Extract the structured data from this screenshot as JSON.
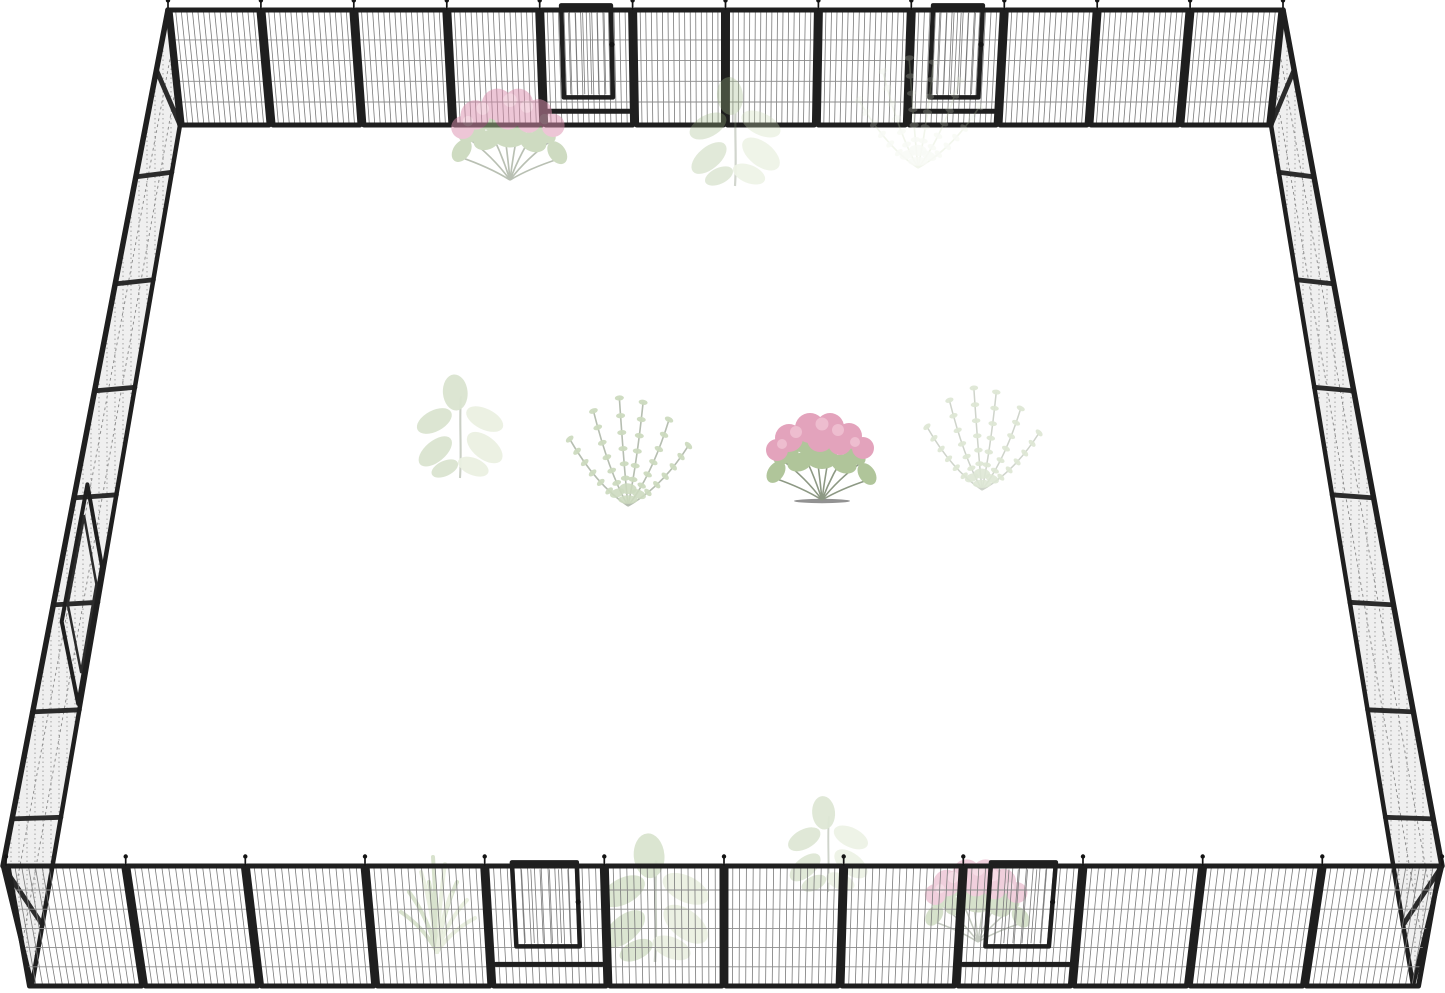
{
  "scene": {
    "description": "Product photo of a black metal heavy-duty dog playpen arranged as a large square outdoor enclosure viewed in perspective, with wire-mesh panels, five access gates (two on the far side, two on the near side, one on the left side), and faint semi-transparent garden plants (pink hydrangea bushes, broad-leaf plants, feathery green plants) inside the pen on a pure white background",
    "canvas": {
      "width": 1445,
      "height": 993,
      "background": "#ffffff"
    },
    "colors": {
      "frame": "#1f1f1f",
      "frame_soft": "#2b2b2b",
      "wire": "#7a7a7a",
      "rail_wire": "#8c8c8c",
      "side_fill": "#ededed",
      "side_wire": "#8f8f8f",
      "pin": "#141414",
      "flower_pink": "#dd8fae",
      "flower_pink_light": "#ecb3c8",
      "leaf_green": "#9fb985",
      "leaf_light": "#cbdab4",
      "leaf_pale": "#e3ebd8",
      "stem": "#75836a",
      "shadow": "#5a5a5a"
    },
    "fence": {
      "top_row": {
        "x1": 168,
        "x2": 1283,
        "y_top": 10,
        "y_bottom": 125,
        "panels": 12,
        "gates": [
          4,
          8
        ],
        "vanish_x": 724,
        "skew": 0.022,
        "rails": [
          0.26,
          0.44,
          0.62,
          0.8
        ],
        "wires": 16,
        "door": {
          "u1": 0.22,
          "u2": 0.78,
          "f_top": -0.04,
          "f_bottom": 0.76,
          "f_thresh": 0.88
        }
      },
      "bottom_row": {
        "x1": 6,
        "x2": 1442,
        "y_top": 866,
        "y_bottom": 986,
        "panels": 12,
        "gates": [
          4,
          8
        ],
        "vanish_x": 724,
        "skew": 0.03,
        "rails": [
          0.2,
          0.36,
          0.52,
          0.68,
          0.84
        ],
        "wires": 17,
        "door": {
          "u1": 0.22,
          "u2": 0.78,
          "f_top": -0.03,
          "f_bottom": 0.67,
          "f_thresh": 0.82
        }
      },
      "left_side": {
        "top_rail": [
          [
            168,
            10
          ],
          [
            3,
            866
          ]
        ],
        "base_rail": [
          [
            180,
            125
          ],
          [
            32,
            985
          ]
        ],
        "panels": 8,
        "post_shift": 0.14,
        "gate": {
          "t1": 0.52,
          "t2": 0.68,
          "u1": 0.25,
          "u2": 0.95
        }
      },
      "right_side": {
        "top_rail": [
          [
            1283,
            10
          ],
          [
            1442,
            866
          ]
        ],
        "base_rail": [
          [
            1271,
            125
          ],
          [
            1413,
            985
          ]
        ],
        "panels": 8,
        "post_shift": -0.14,
        "gate": null
      }
    },
    "plants": [
      {
        "type": "hydrangea",
        "x": 510,
        "y": 180,
        "scale": 1.05,
        "opacity": 0.5,
        "layer": "front-top"
      },
      {
        "type": "broadleaf",
        "x": 735,
        "y": 186,
        "scale": 1.0,
        "opacity": 0.33,
        "layer": "front-top"
      },
      {
        "type": "zz",
        "x": 918,
        "y": 168,
        "scale": 1.1,
        "opacity": 0.24,
        "layer": "front-top",
        "pale": true
      },
      {
        "type": "broadleaf",
        "x": 460,
        "y": 478,
        "scale": 0.95,
        "opacity": 0.38,
        "layer": "mid"
      },
      {
        "type": "zz",
        "x": 628,
        "y": 506,
        "scale": 1.08,
        "opacity": 0.52,
        "layer": "mid"
      },
      {
        "type": "hydrangea",
        "x": 822,
        "y": 500,
        "scale": 1.0,
        "opacity": 0.82,
        "layer": "mid"
      },
      {
        "type": "zz",
        "x": 982,
        "y": 490,
        "scale": 1.02,
        "opacity": 0.34,
        "layer": "mid"
      },
      {
        "type": "cactus",
        "x": 437,
        "y": 952,
        "scale": 1.0,
        "opacity": 0.4,
        "layer": "behind-bottom"
      },
      {
        "type": "broadleaf",
        "x": 655,
        "y": 962,
        "scale": 1.18,
        "opacity": 0.4,
        "layer": "behind-bottom"
      },
      {
        "type": "broadleaf",
        "x": 828,
        "y": 892,
        "scale": 0.88,
        "opacity": 0.34,
        "layer": "behind-bottom"
      },
      {
        "type": "hydrangea",
        "x": 978,
        "y": 942,
        "scale": 0.95,
        "opacity": 0.42,
        "layer": "behind-bottom"
      }
    ]
  }
}
